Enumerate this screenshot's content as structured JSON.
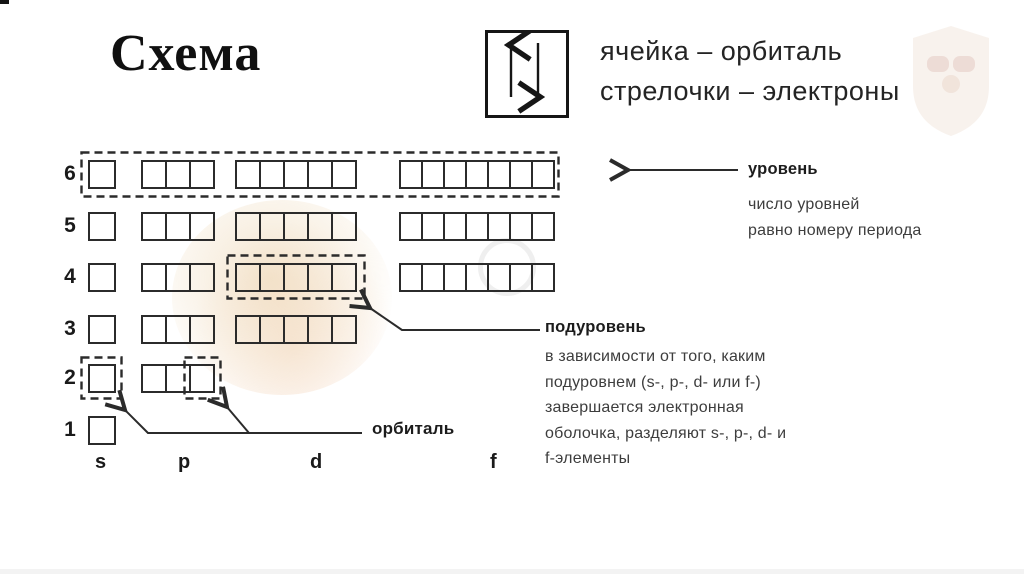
{
  "page": {
    "title": "Схема"
  },
  "legend": {
    "icon": "up-down-arrows-in-cell",
    "line1": "ячейка – орбиталь",
    "line2": "стрелочки – электроны"
  },
  "diagram": {
    "levels": [
      {
        "number": "6",
        "orbitals": {
          "s": 1,
          "p": 3,
          "d": 5,
          "f": 7
        },
        "highlight": "whole-level-dashed"
      },
      {
        "number": "5",
        "orbitals": {
          "s": 1,
          "p": 3,
          "d": 5,
          "f": 7
        },
        "highlight": null
      },
      {
        "number": "4",
        "orbitals": {
          "s": 1,
          "p": 3,
          "d": 5,
          "f": 7
        },
        "highlight": "d-sublevel-dashed"
      },
      {
        "number": "3",
        "orbitals": {
          "s": 1,
          "p": 3,
          "d": 5
        },
        "highlight": null
      },
      {
        "number": "2",
        "orbitals": {
          "s": 1,
          "p": 3
        },
        "highlight": "s-orbital-and-last-p-orbital-dashed"
      },
      {
        "number": "1",
        "orbitals": {
          "s": 1
        },
        "highlight": null
      }
    ],
    "column_labels": [
      "s",
      "p",
      "d",
      "f"
    ]
  },
  "annotations": {
    "level": {
      "label": "уровень",
      "note": [
        "число уровней",
        "равно номеру периода"
      ]
    },
    "sublevel": {
      "label": "подуровень",
      "note": [
        "в зависимости от того, каким",
        "подуровнем (s-, p-, d- или f-)",
        "завершается электронная",
        "оболочка, разделяют s-, p-, d- и",
        "f-элементы"
      ]
    },
    "orbital": {
      "label": "орбиталь"
    }
  },
  "colors": {
    "line": "#2b2b2b",
    "label_text": "#1c1c1c",
    "note_text": "#3d3d3d"
  }
}
